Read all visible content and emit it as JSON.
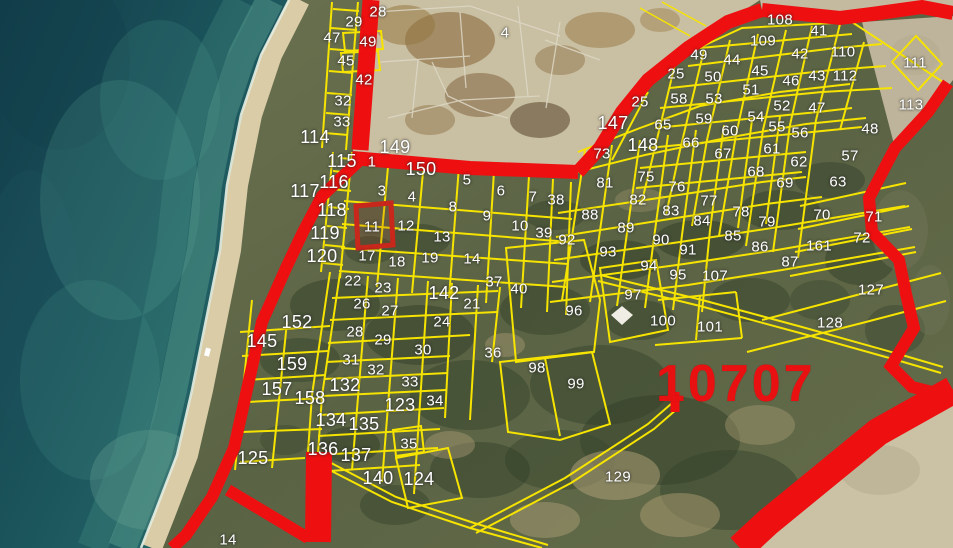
{
  "map": {
    "region_code": "10707",
    "selected_parcel_label": "11",
    "colors": {
      "parcel_line": "#f6e400",
      "road": "#ee1010",
      "selected_highlight": "#c8271c",
      "water": "#2c7370",
      "sand": "#c9bfa2",
      "label_text": "#ffffff",
      "zone_text": "#e81010"
    },
    "labels": [
      {
        "t": "28",
        "x": 378,
        "y": 12
      },
      {
        "t": "29",
        "x": 354,
        "y": 22
      },
      {
        "t": "47",
        "x": 332,
        "y": 38
      },
      {
        "t": "49",
        "x": 368,
        "y": 42
      },
      {
        "t": "45",
        "x": 346,
        "y": 61
      },
      {
        "t": "42",
        "x": 364,
        "y": 80
      },
      {
        "t": "32",
        "x": 343,
        "y": 101
      },
      {
        "t": "33",
        "x": 342,
        "y": 122
      },
      {
        "t": "114",
        "x": 315,
        "y": 137,
        "s": 2
      },
      {
        "t": "149",
        "x": 395,
        "y": 147,
        "s": 2
      },
      {
        "t": "115",
        "x": 342,
        "y": 161,
        "s": 2
      },
      {
        "t": "1",
        "x": 372,
        "y": 162
      },
      {
        "t": "150",
        "x": 421,
        "y": 169,
        "s": 2
      },
      {
        "t": "116",
        "x": 334,
        "y": 182,
        "s": 2
      },
      {
        "t": "117",
        "x": 305,
        "y": 191,
        "s": 2
      },
      {
        "t": "3",
        "x": 382,
        "y": 191
      },
      {
        "t": "5",
        "x": 467,
        "y": 180
      },
      {
        "t": "6",
        "x": 501,
        "y": 191
      },
      {
        "t": "4",
        "x": 412,
        "y": 197
      },
      {
        "t": "7",
        "x": 533,
        "y": 197
      },
      {
        "t": "38",
        "x": 556,
        "y": 200
      },
      {
        "t": "8",
        "x": 453,
        "y": 207
      },
      {
        "t": "118",
        "x": 332,
        "y": 210,
        "s": 2
      },
      {
        "t": "9",
        "x": 487,
        "y": 216
      },
      {
        "t": "11",
        "x": 372,
        "y": 227
      },
      {
        "t": "12",
        "x": 406,
        "y": 226
      },
      {
        "t": "10",
        "x": 520,
        "y": 226
      },
      {
        "t": "119",
        "x": 325,
        "y": 233,
        "s": 2
      },
      {
        "t": "39",
        "x": 544,
        "y": 233
      },
      {
        "t": "13",
        "x": 442,
        "y": 237
      },
      {
        "t": "92",
        "x": 567,
        "y": 240
      },
      {
        "t": "120",
        "x": 322,
        "y": 256,
        "s": 2
      },
      {
        "t": "17",
        "x": 367,
        "y": 256
      },
      {
        "t": "19",
        "x": 430,
        "y": 258
      },
      {
        "t": "14",
        "x": 472,
        "y": 259
      },
      {
        "t": "18",
        "x": 397,
        "y": 262
      },
      {
        "t": "4",
        "x": 505,
        "y": 33
      },
      {
        "t": "108",
        "x": 780,
        "y": 20
      },
      {
        "t": "41",
        "x": 819,
        "y": 31
      },
      {
        "t": "109",
        "x": 763,
        "y": 41
      },
      {
        "t": "110",
        "x": 843,
        "y": 52
      },
      {
        "t": "42",
        "x": 800,
        "y": 54
      },
      {
        "t": "49",
        "x": 699,
        "y": 55
      },
      {
        "t": "44",
        "x": 732,
        "y": 60
      },
      {
        "t": "111",
        "x": 915,
        "y": 63
      },
      {
        "t": "25",
        "x": 676,
        "y": 74
      },
      {
        "t": "45",
        "x": 760,
        "y": 71
      },
      {
        "t": "43",
        "x": 817,
        "y": 76
      },
      {
        "t": "112",
        "x": 845,
        "y": 76
      },
      {
        "t": "50",
        "x": 713,
        "y": 77
      },
      {
        "t": "46",
        "x": 791,
        "y": 81
      },
      {
        "t": "51",
        "x": 751,
        "y": 90
      },
      {
        "t": "58",
        "x": 679,
        "y": 99
      },
      {
        "t": "53",
        "x": 714,
        "y": 99
      },
      {
        "t": "25",
        "x": 640,
        "y": 102
      },
      {
        "t": "52",
        "x": 782,
        "y": 106
      },
      {
        "t": "113",
        "x": 911,
        "y": 105
      },
      {
        "t": "47",
        "x": 817,
        "y": 108
      },
      {
        "t": "59",
        "x": 704,
        "y": 119
      },
      {
        "t": "54",
        "x": 756,
        "y": 117
      },
      {
        "t": "147",
        "x": 613,
        "y": 123,
        "s": 2
      },
      {
        "t": "65",
        "x": 663,
        "y": 125
      },
      {
        "t": "55",
        "x": 777,
        "y": 127
      },
      {
        "t": "48",
        "x": 870,
        "y": 129
      },
      {
        "t": "60",
        "x": 730,
        "y": 131
      },
      {
        "t": "56",
        "x": 800,
        "y": 133
      },
      {
        "t": "66",
        "x": 691,
        "y": 143
      },
      {
        "t": "148",
        "x": 643,
        "y": 145,
        "s": 2
      },
      {
        "t": "61",
        "x": 772,
        "y": 149
      },
      {
        "t": "67",
        "x": 723,
        "y": 154
      },
      {
        "t": "73",
        "x": 602,
        "y": 154
      },
      {
        "t": "57",
        "x": 850,
        "y": 156
      },
      {
        "t": "62",
        "x": 799,
        "y": 162
      },
      {
        "t": "68",
        "x": 756,
        "y": 172
      },
      {
        "t": "75",
        "x": 646,
        "y": 177
      },
      {
        "t": "63",
        "x": 838,
        "y": 182
      },
      {
        "t": "81",
        "x": 605,
        "y": 183
      },
      {
        "t": "69",
        "x": 785,
        "y": 183
      },
      {
        "t": "76",
        "x": 677,
        "y": 187
      },
      {
        "t": "82",
        "x": 638,
        "y": 200
      },
      {
        "t": "77",
        "x": 709,
        "y": 201
      },
      {
        "t": "83",
        "x": 671,
        "y": 211
      },
      {
        "t": "88",
        "x": 590,
        "y": 215
      },
      {
        "t": "70",
        "x": 822,
        "y": 215
      },
      {
        "t": "71",
        "x": 874,
        "y": 217
      },
      {
        "t": "84",
        "x": 702,
        "y": 221
      },
      {
        "t": "78",
        "x": 741,
        "y": 212
      },
      {
        "t": "79",
        "x": 767,
        "y": 222
      },
      {
        "t": "89",
        "x": 626,
        "y": 228
      },
      {
        "t": "85",
        "x": 733,
        "y": 236
      },
      {
        "t": "72",
        "x": 862,
        "y": 238
      },
      {
        "t": "90",
        "x": 661,
        "y": 240
      },
      {
        "t": "161",
        "x": 819,
        "y": 246
      },
      {
        "t": "86",
        "x": 760,
        "y": 247
      },
      {
        "t": "91",
        "x": 688,
        "y": 250
      },
      {
        "t": "93",
        "x": 608,
        "y": 252
      },
      {
        "t": "87",
        "x": 790,
        "y": 262
      },
      {
        "t": "94",
        "x": 649,
        "y": 266
      },
      {
        "t": "95",
        "x": 678,
        "y": 275
      },
      {
        "t": "107",
        "x": 715,
        "y": 276
      },
      {
        "t": "127",
        "x": 871,
        "y": 290
      },
      {
        "t": "128",
        "x": 830,
        "y": 323
      },
      {
        "t": "37",
        "x": 494,
        "y": 282
      },
      {
        "t": "40",
        "x": 519,
        "y": 289
      },
      {
        "t": "142",
        "x": 444,
        "y": 293,
        "s": 2
      },
      {
        "t": "97",
        "x": 633,
        "y": 295
      },
      {
        "t": "21",
        "x": 472,
        "y": 304
      },
      {
        "t": "96",
        "x": 574,
        "y": 311
      },
      {
        "t": "100",
        "x": 663,
        "y": 321
      },
      {
        "t": "101",
        "x": 710,
        "y": 327
      },
      {
        "t": "24",
        "x": 442,
        "y": 322
      },
      {
        "t": "30",
        "x": 423,
        "y": 350
      },
      {
        "t": "36",
        "x": 493,
        "y": 353
      },
      {
        "t": "98",
        "x": 537,
        "y": 368
      },
      {
        "t": "99",
        "x": 576,
        "y": 384
      },
      {
        "t": "129",
        "x": 618,
        "y": 477
      },
      {
        "t": "22",
        "x": 353,
        "y": 281
      },
      {
        "t": "23",
        "x": 383,
        "y": 288
      },
      {
        "t": "26",
        "x": 362,
        "y": 304
      },
      {
        "t": "27",
        "x": 390,
        "y": 311
      },
      {
        "t": "152",
        "x": 297,
        "y": 322,
        "s": 2
      },
      {
        "t": "28",
        "x": 355,
        "y": 332
      },
      {
        "t": "29",
        "x": 383,
        "y": 340
      },
      {
        "t": "145",
        "x": 262,
        "y": 341,
        "s": 2
      },
      {
        "t": "31",
        "x": 351,
        "y": 360
      },
      {
        "t": "159",
        "x": 292,
        "y": 364,
        "s": 2
      },
      {
        "t": "32",
        "x": 376,
        "y": 370
      },
      {
        "t": "33",
        "x": 410,
        "y": 382
      },
      {
        "t": "132",
        "x": 345,
        "y": 385,
        "s": 2
      },
      {
        "t": "157",
        "x": 277,
        "y": 389,
        "s": 2
      },
      {
        "t": "158",
        "x": 310,
        "y": 398,
        "s": 2
      },
      {
        "t": "34",
        "x": 435,
        "y": 401
      },
      {
        "t": "123",
        "x": 400,
        "y": 405,
        "s": 2
      },
      {
        "t": "134",
        "x": 331,
        "y": 420,
        "s": 2
      },
      {
        "t": "135",
        "x": 364,
        "y": 424,
        "s": 2
      },
      {
        "t": "35",
        "x": 409,
        "y": 444
      },
      {
        "t": "136",
        "x": 323,
        "y": 449,
        "s": 2
      },
      {
        "t": "137",
        "x": 356,
        "y": 455,
        "s": 2
      },
      {
        "t": "125",
        "x": 253,
        "y": 458,
        "s": 2
      },
      {
        "t": "140",
        "x": 378,
        "y": 478,
        "s": 2
      },
      {
        "t": "124",
        "x": 419,
        "y": 479,
        "s": 2
      },
      {
        "t": "14",
        "x": 228,
        "y": 540
      }
    ]
  }
}
